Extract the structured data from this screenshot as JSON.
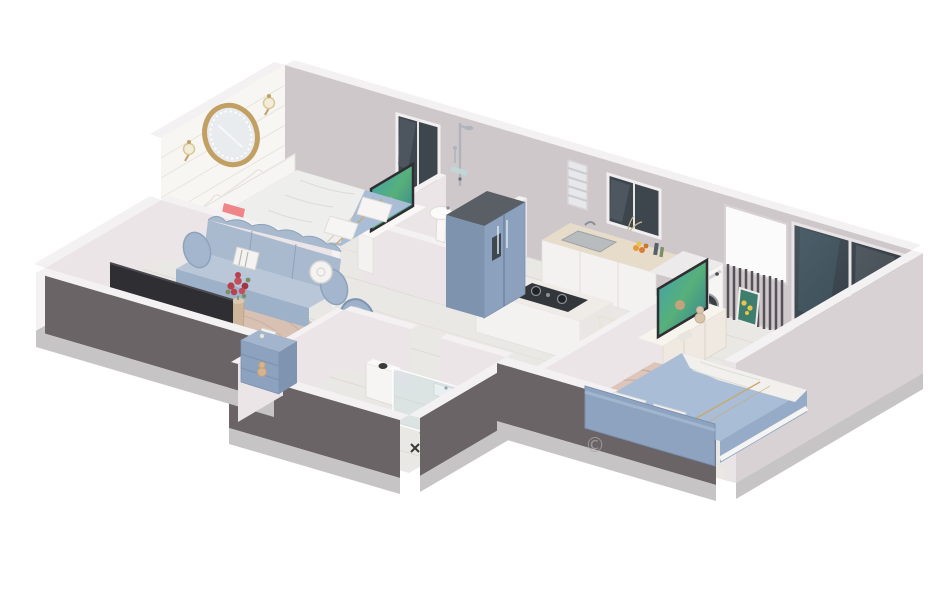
{
  "image": {
    "kind": "3d-isometric-floorplan-render",
    "description": "Cutaway 3D rendering of a one-bedroom-plus apartment; no labels or UI text visible",
    "watermark": {
      "symbol": "©"
    }
  },
  "palette": {
    "charcoal": "#6a6466",
    "plinth": "#c6c4c5",
    "backwall": "#cfc8cb",
    "wallcap": "#f4f1f2",
    "wallinner": "#ece5e8",
    "brick": "#f7f6f3",
    "floor": "#eae8e4",
    "plankline": "#dedbd6",
    "wood": "#e7dcc9",
    "counterwhite": "#f4f2f0",
    "applianceblue": "#8ba1bd",
    "furnitureblue": "#a9bacf",
    "duvet": "#aabdd6",
    "cream": "#efe9e2",
    "rugtan": "#d8c1b3",
    "rugpink": "#ddc5ba",
    "coral": "#ef8489",
    "glassdark": "#3e464d",
    "teal": "#2f8da0",
    "gold": "#c2a064",
    "fabricwhite": "#f1f0ed",
    "railing": "#555156",
    "tvdark": "#2f2e33",
    "rose": "#b8414e",
    "leafgreen": "#7a8f62",
    "daylight": "#fbfbfb",
    "watermarkgray": "#aaa6a8"
  },
  "rooms": [
    {
      "name": "bedroom-1",
      "furniture": [
        "double-bed",
        "white-footboard",
        "round-gold-mirror",
        "wall-sconce",
        "wall-sconce",
        "window",
        "tv-sideboard",
        "accent-rug"
      ]
    },
    {
      "name": "bathroom-1",
      "furniture": [
        "shower-column",
        "toilet",
        "pedestal-sink"
      ]
    },
    {
      "name": "kitchen",
      "furniture": [
        "counter-with-sink",
        "louver-vent",
        "window",
        "cooktop-island",
        "fridge",
        "washing-machine",
        "radiator-window"
      ]
    },
    {
      "name": "hallway",
      "furniture": [
        "white-chair"
      ]
    },
    {
      "name": "living-room",
      "furniture": [
        "sofa",
        "armchair",
        "round-rug",
        "flower-pedestal",
        "wall-tv",
        "blue-cabinet",
        "book",
        "teddy"
      ]
    },
    {
      "name": "bedroom-2",
      "furniture": [
        "double-bed",
        "blue-headboard",
        "round-rug",
        "tv-sideboard",
        "tv",
        "teddy",
        "sliding-glass-door",
        "sunflower-picture"
      ]
    },
    {
      "name": "bathroom-2",
      "furniture": [
        "toilet",
        "vanity",
        "shower-fittings",
        "glass-screen"
      ]
    }
  ]
}
